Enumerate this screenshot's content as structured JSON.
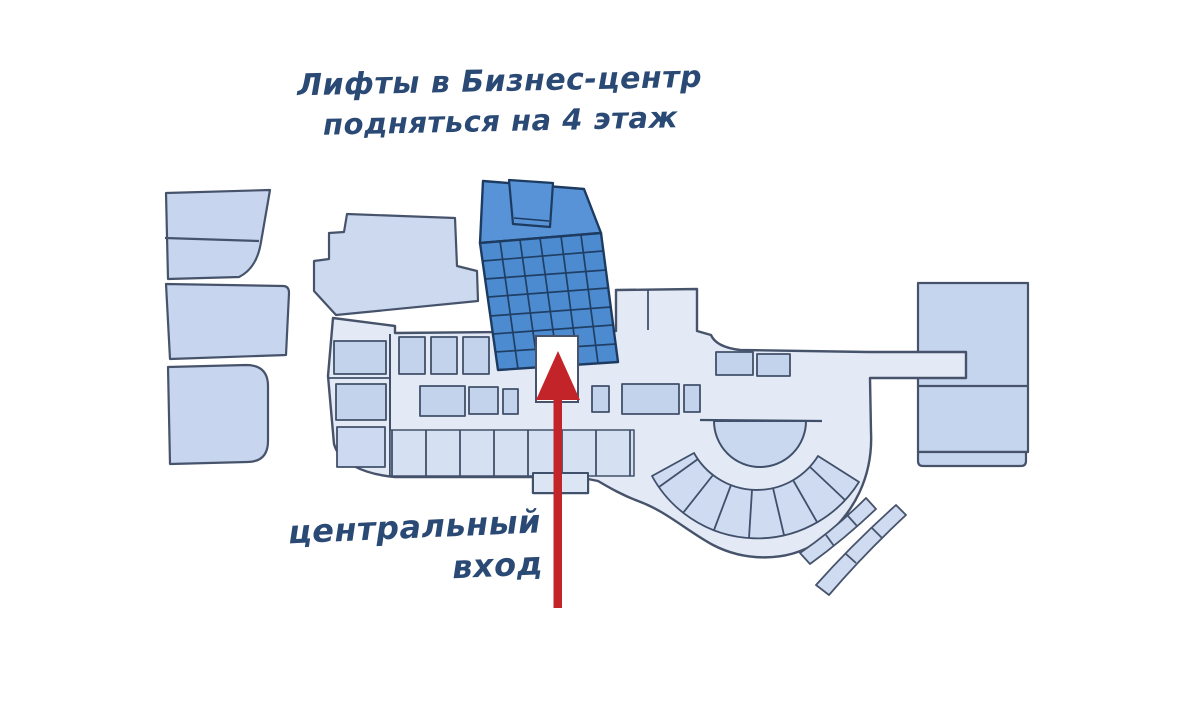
{
  "annotations": {
    "elevators_note": {
      "line1": "Лифты в Бизнес-центр",
      "line2": "подняться на 4 этаж"
    },
    "entrance_note": {
      "line1": "центральный",
      "line2": "вход"
    }
  },
  "icons": {
    "entrance_arrow": "up-arrow-icon"
  },
  "colors": {
    "background": "#ffffff",
    "outline": "#46536b",
    "building_fill": "#c7d5ee",
    "building_fill_light": "#e3eaf5",
    "room_fill": "#c3d3ec",
    "tower_roof_blue": "#5793d6",
    "tower_facade_blue": "#4d8bd1",
    "tower_line_navy": "#1d3b60",
    "arrow_red": "#c3242a",
    "annotation_text": "#2a4a75"
  }
}
